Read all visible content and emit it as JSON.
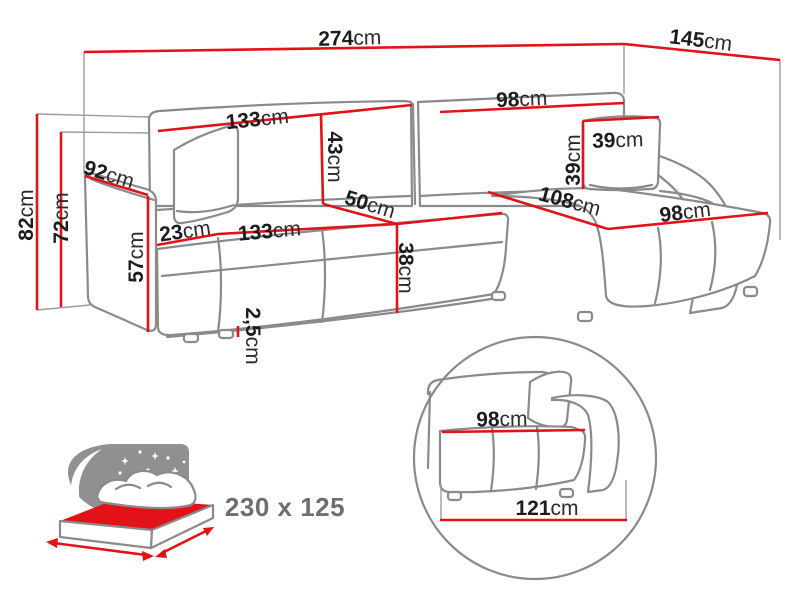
{
  "colors": {
    "dimension_line": "#e11218",
    "sofa_outline": "#8a8a8a",
    "label_text": "#1c1c1c",
    "muted_text": "#6e6e6e",
    "background": "#ffffff"
  },
  "diagram": {
    "dimensions": {
      "total_width": {
        "value": "274",
        "unit": "cm"
      },
      "chaise_depth": {
        "value": "145",
        "unit": "cm"
      },
      "back_left_width": {
        "value": "133",
        "unit": "cm"
      },
      "back_right_width": {
        "value": "98",
        "unit": "cm"
      },
      "backrest_height": {
        "value": "43",
        "unit": "cm"
      },
      "pillow_width": {
        "value": "39",
        "unit": "cm"
      },
      "pillow_height": {
        "value": "39",
        "unit": "cm"
      },
      "arm_depth": {
        "value": "92",
        "unit": "cm"
      },
      "total_height": {
        "value": "82",
        "unit": "cm"
      },
      "seat_back_height": {
        "value": "72",
        "unit": "cm"
      },
      "arm_width": {
        "value": "23",
        "unit": "cm"
      },
      "seat_width": {
        "value": "133",
        "unit": "cm"
      },
      "seat_depth": {
        "value": "50",
        "unit": "cm"
      },
      "arm_height": {
        "value": "57",
        "unit": "cm"
      },
      "seat_height": {
        "value": "38",
        "unit": "cm"
      },
      "leg_height": {
        "value": "2,5",
        "unit": "cm"
      },
      "chaise_width": {
        "value": "108",
        "unit": "cm"
      },
      "chaise_seat_width": {
        "value": "98",
        "unit": "cm"
      }
    },
    "detail_view": {
      "seat_width": {
        "value": "98",
        "unit": "cm"
      },
      "module_width": {
        "value": "121",
        "unit": "cm"
      }
    },
    "sleeping_area": {
      "label": "230 x 125"
    },
    "icons": {
      "bed": "sleeping-function-bed-icon",
      "detail": "detail-zoom-circle"
    }
  }
}
